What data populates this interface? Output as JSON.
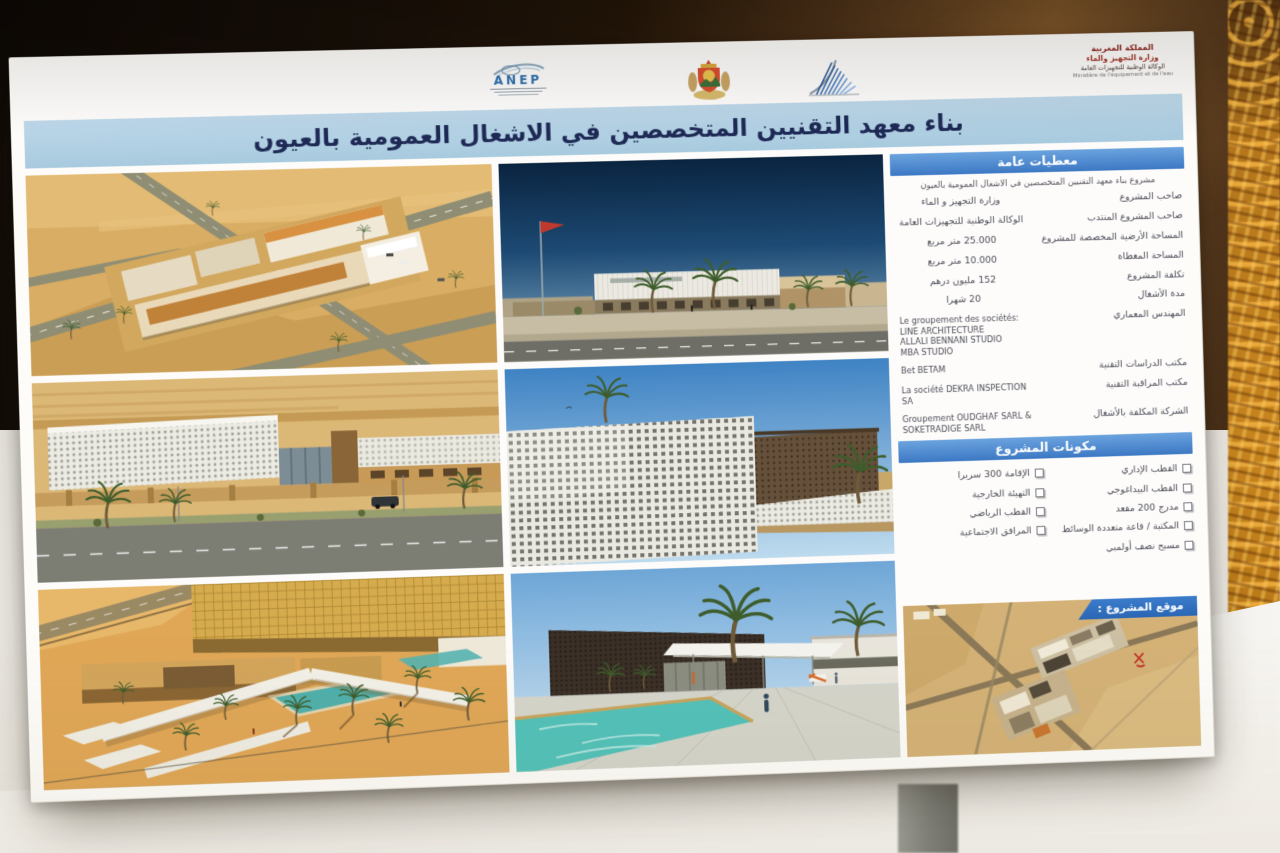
{
  "colors": {
    "accent_blue": "#3c78c4",
    "title_band_blue": "#aecde2",
    "title_navy": "#1e2a55",
    "banner_blue": "#2e6fc2",
    "curtain_brown": "#4c3118",
    "carpet_gold": "#b4761c",
    "table_white": "#f5f3ef"
  },
  "header": {
    "anep_label": "ANEP",
    "ministry_block": {
      "line1": "المملكة المغربية",
      "line2": "وزارة التجهيز والماء",
      "line3": "الوكالة الوطنية للتجهيزات العامة",
      "line4": "Ministère de l'équipement et de l'eau"
    }
  },
  "title": "بناء معهد التقنيين المتخصصين في الاشغال العمومية بالعيون",
  "general_data": {
    "header": "معطيات عامة",
    "intro": "مشروع بناء معهد التقنيين المتخصصين في الاشغال العمومية بالعيون",
    "rows": [
      {
        "label": "صاحب المشروع",
        "value": "وزارة التجهيز و الماء"
      },
      {
        "label": "صاحب المشروع المنتدب",
        "value": "الوكالة الوطنية للتجهيزات العامة"
      },
      {
        "label": "المساحة الأرضية المخصصة للمشروع",
        "value": "25.000 متر مربع"
      },
      {
        "label": "المساحة المغطاة",
        "value": "10.000 متر مربع"
      },
      {
        "label": "تكلفة المشروع",
        "value": "152 مليون درهم"
      },
      {
        "label": "مدة الأشغال",
        "value": "20 شهرا"
      },
      {
        "label": "المهندس المعماري",
        "value": "Le groupement des sociétés:\nLINE ARCHITECTURE\nALLALI BENNANI STUDIO\nMBA STUDIO"
      },
      {
        "label": "مكتب الدراسات التقنية",
        "value": "Bet BETAM"
      },
      {
        "label": "مكتب المراقبة التقنية",
        "value": "La société DEKRA INSPECTION\nSA"
      },
      {
        "label": "الشركة المكلفة بالأشغال",
        "value": "Groupement OUDGHAF SARL &\nSOKETRADIGE SARL"
      }
    ]
  },
  "components": {
    "header": "مكونات المشروع",
    "col1": [
      "القطب الإداري",
      "القطب البيداغوجي",
      "مدرج 200 مقعد",
      "المكتبة / قاعة متعددة الوسائط",
      "مسبح نصف أولمبي"
    ],
    "col2": [
      "الإقامة 300 سريرا",
      "التهيئة الخارجية",
      "القطب الرياضي",
      "المرافق الاجتماعية"
    ]
  },
  "site_map": {
    "banner": "موقع المشروع :"
  }
}
